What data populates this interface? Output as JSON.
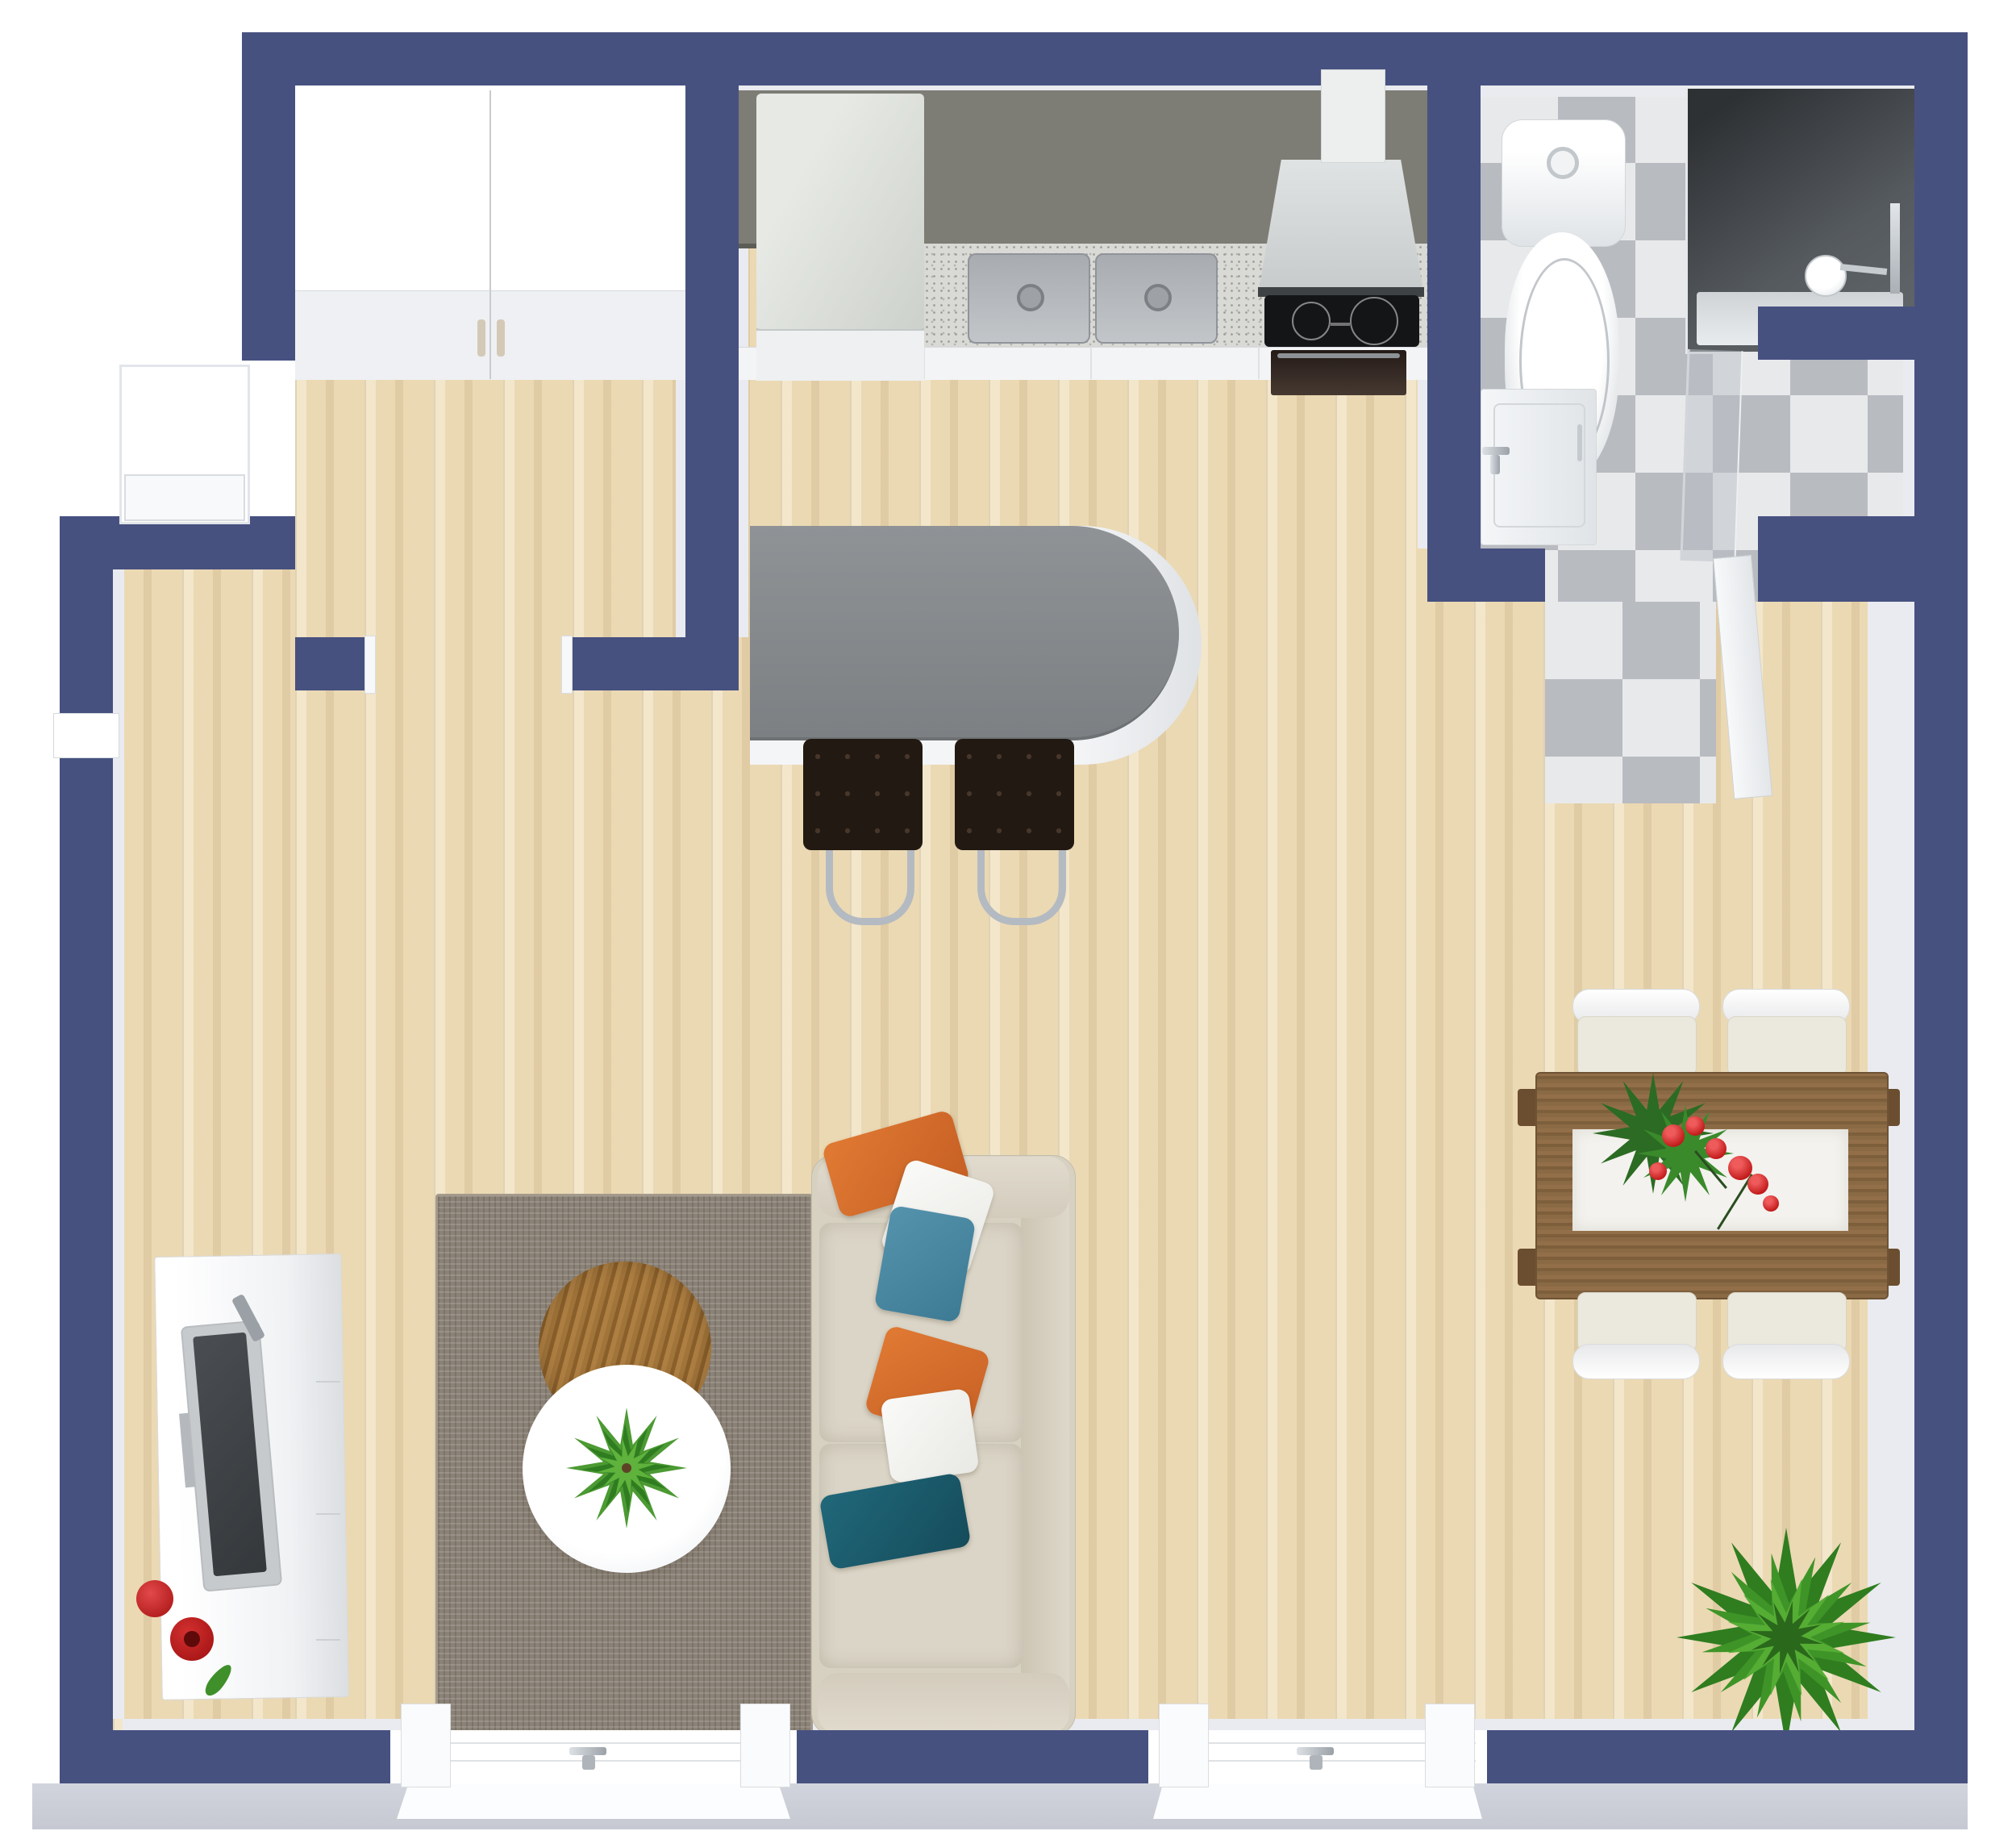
{
  "scene": {
    "kind": "3d-floorplan-top-view",
    "description": "Top-down 3D render of a studio apartment floor plan with navy walls, light wood flooring, kitchen, bathroom, living and dining areas",
    "rooms": [
      "entry-hall",
      "kitchen",
      "bathroom",
      "living-room",
      "dining-area"
    ]
  },
  "colors": {
    "wall": "#475180",
    "wallFace": "#e9ebf0",
    "floor": "#ebd9b4",
    "tileLight": "#e8e9eb",
    "tileDark": "#b8bbc0",
    "apron": "#cfd1db",
    "counter": "#7d7d75",
    "granite": "#d9d9d5",
    "islandTop": "#878b8e",
    "islandBase": "#f2f3f5",
    "fridge": "#dbdfd9",
    "closet": "#f7f8f9",
    "stool": "#221912",
    "chrome": "#b4bac1",
    "sofa": "#d7d1c2",
    "rug": "#8b8277",
    "tableWood": "#84653f",
    "runner": "#f3f2ee",
    "chair": "#ebe8dd",
    "orange": "#d96f2e",
    "blue": "#4886a0",
    "teal": "#1d5f70",
    "pillowWhite": "#f4f4f2",
    "red": "#c01818",
    "green": "#3f9428",
    "greenDark": "#2f7d1f",
    "tv": "#c6cacd",
    "screen": "#3c4043",
    "oven": "#2f2520",
    "cooktop": "#141517",
    "doorWhite": "#f5f7f9"
  },
  "furniture": {
    "entry": [
      "double-door wardrobe closet"
    ],
    "kitchen": [
      "refrigerator",
      "double-basin sink",
      "granite countertop",
      "range hood with duct",
      "induction cooktop",
      "oven",
      "kitchen island with rounded end",
      "2 tufted bar stools"
    ],
    "bathroom": [
      "toilet",
      "vanity washbasin with faucet",
      "glass walk-in shower with shower head",
      "open bathroom door",
      "checkerboard tile floor",
      "storage niche"
    ],
    "living": [
      "area rug",
      "round wood coffee table",
      "round white coffee table",
      "small potted plant",
      "3-seat sofa",
      "6 throw pillows (orange, white, blue, orange, white, teal)",
      "white TV sideboard",
      "flat TV",
      "remote control",
      "red bowl",
      "red vase with leaf"
    ],
    "dining": [
      "wood dining table",
      "white table runner",
      "red flower centerpiece",
      "4 upholstered chairs",
      "large potted plant"
    ],
    "openings": [
      "entry alcove on west wall",
      "small west window",
      "2 south windows with handles",
      "doorway between entry and living room"
    ]
  }
}
